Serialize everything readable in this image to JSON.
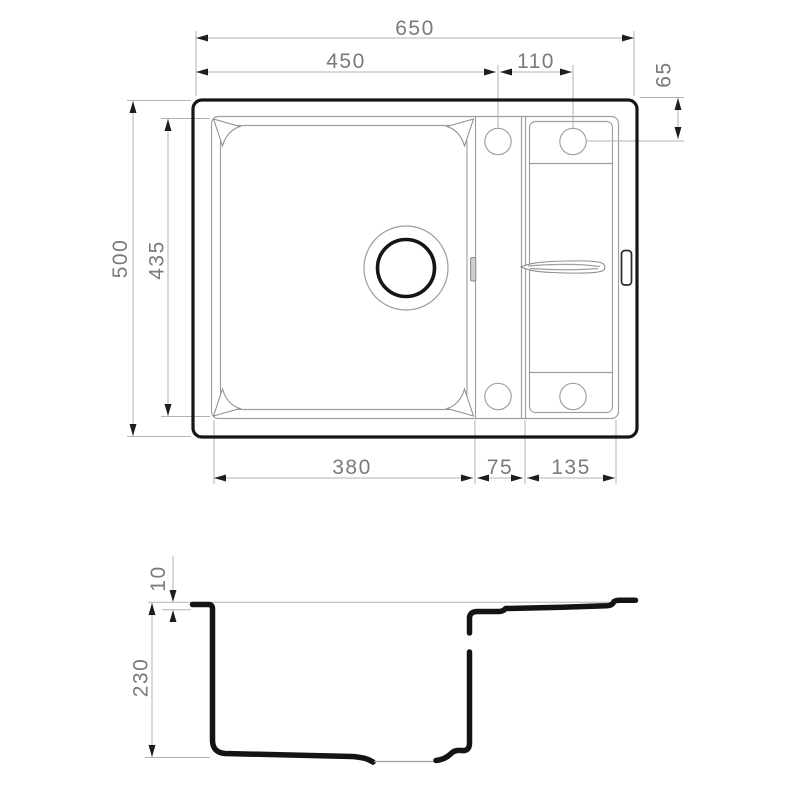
{
  "drawing": {
    "name": "kitchen-sink-technical-drawing",
    "units": "mm",
    "colors": {
      "background": "#ffffff",
      "outline_strong": "#161616",
      "outline_thin": "#9f9f9f",
      "dimension_line": "#b3b3b3",
      "arrowhead": "#1e1e1e",
      "label_text": "#7a7a7a"
    }
  },
  "top_view": {
    "dim_overall_width": "650",
    "dim_left_to_faucet": "450",
    "dim_faucet_spacing": "110",
    "dim_faucet_from_top": "65",
    "dim_overall_depth": "500",
    "dim_bowl_depth": "435",
    "dim_bowl_width": "380",
    "dim_divider_width": "75",
    "dim_drainer_width": "135"
  },
  "section_view": {
    "dim_rim_thickness": "10",
    "dim_bowl_height": "230"
  }
}
